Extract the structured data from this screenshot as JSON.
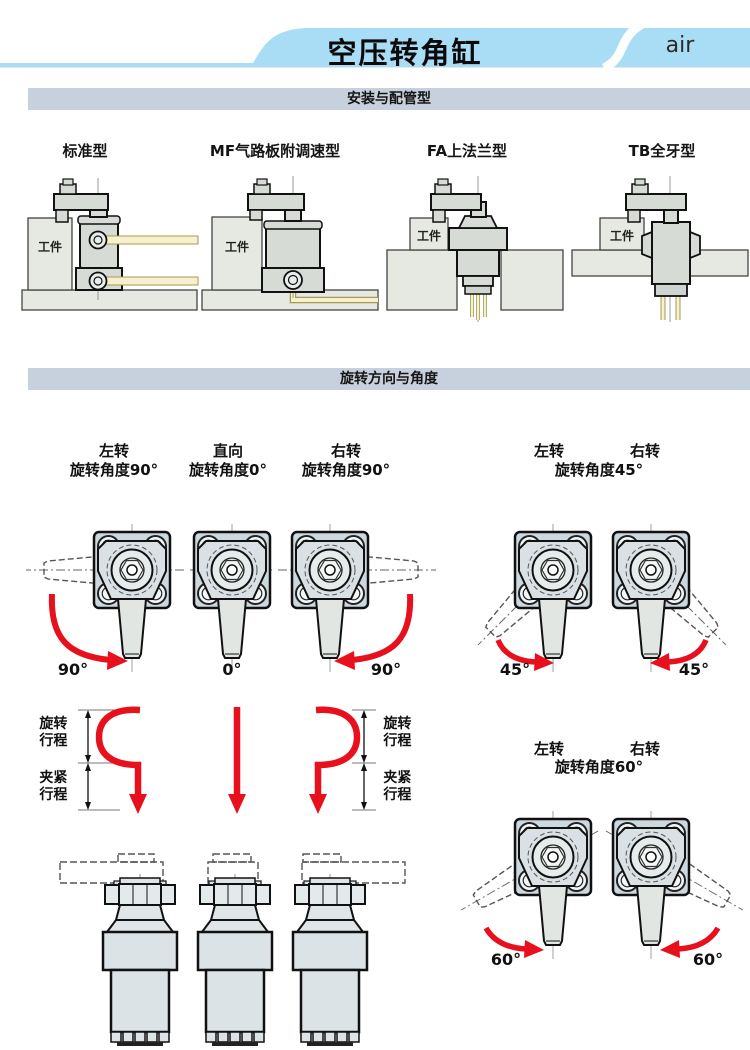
{
  "header": {
    "title": "空压转角缸",
    "brand": "air"
  },
  "section_bars": {
    "mounting": "安装与配管型",
    "rotation": "旋转方向与角度"
  },
  "mounting": {
    "types": [
      {
        "label": "标准型"
      },
      {
        "label": "MF气路板附调速型"
      },
      {
        "label": "FA上法兰型"
      },
      {
        "label": "TB全牙型"
      }
    ],
    "workpiece": "工件"
  },
  "rotation": {
    "columns": [
      {
        "dir": "左转",
        "caption": "旋转角度90°",
        "angle": "90°"
      },
      {
        "dir": "直向",
        "caption": "旋转角度0°",
        "angle": "0°"
      },
      {
        "dir": "右转",
        "caption": "旋转角度90°",
        "angle": "90°"
      }
    ],
    "deg45": {
      "left_dir": "左转",
      "right_dir": "右转",
      "caption": "旋转角度45°",
      "left_angle": "45°",
      "right_angle": "45°"
    },
    "deg60": {
      "left_dir": "左转",
      "right_dir": "右转",
      "caption": "旋转角度60°",
      "left_angle": "60°",
      "right_angle": "60°"
    },
    "strokes": {
      "rotate": "旋转行程",
      "clamp": "夹紧行程"
    }
  },
  "colors": {
    "banner": "#a9dcf5",
    "underline": "#addcf2",
    "section_bar": "#c7d1dd",
    "red_arrow": "#e8101c",
    "flange": "#ccd8de",
    "body_gray": "#d7dbd6",
    "block_gray": "#e6e9e1",
    "tube_yellow": "#f6f0cc"
  }
}
